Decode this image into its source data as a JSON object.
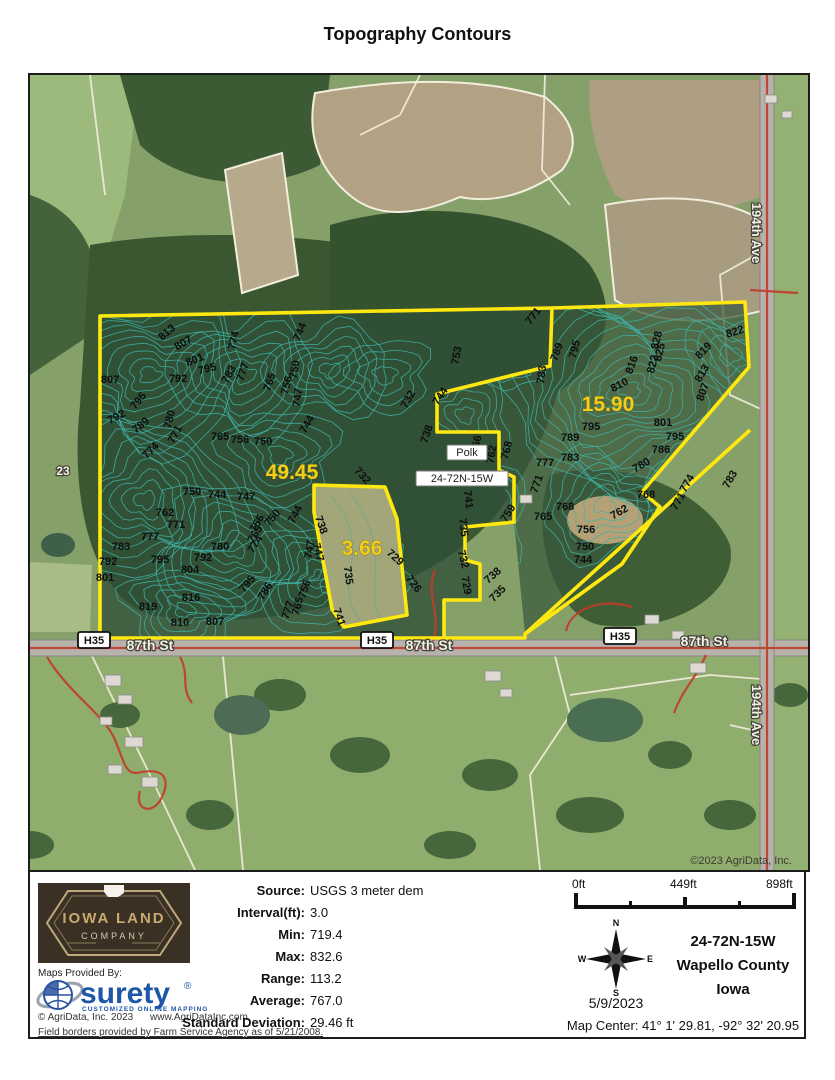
{
  "page_title": "Topography Contours",
  "map": {
    "area_labels": [
      {
        "text": "49.45",
        "x": 262,
        "y": 404
      },
      {
        "text": "15.90",
        "x": 578,
        "y": 336
      },
      {
        "text": "3.66",
        "x": 332,
        "y": 480
      }
    ],
    "place_boxes": [
      {
        "text": "Polk",
        "x": 437,
        "y": 381,
        "w": 40
      },
      {
        "text": "24-72N-15W",
        "x": 432,
        "y": 407,
        "w": 92
      }
    ],
    "section_label": {
      "text": "23",
      "x": 33,
      "y": 400
    },
    "road_labels": [
      {
        "text": "87th St",
        "x": 120,
        "y": 575,
        "rot": 0
      },
      {
        "text": "87th St",
        "x": 399,
        "y": 575,
        "rot": 0
      },
      {
        "text": "87th St",
        "x": 674,
        "y": 571,
        "rot": 0
      },
      {
        "text": "194th Ave",
        "x": 722,
        "y": 158,
        "rot": 90
      },
      {
        "text": "194th Ave",
        "x": 722,
        "y": 640,
        "rot": 90
      }
    ],
    "highway_badges": [
      {
        "text": "H35",
        "x": 64,
        "y": 569
      },
      {
        "text": "H35",
        "x": 347,
        "y": 569
      },
      {
        "text": "H35",
        "x": 590,
        "y": 565
      }
    ],
    "copyright": "©2023 AgriData, Inc.",
    "contour_labels": [
      [
        "813",
        139,
        260,
        -40
      ],
      [
        "807",
        155,
        271,
        -30
      ],
      [
        "801",
        166,
        288,
        -22
      ],
      [
        "795",
        178,
        297,
        -15
      ],
      [
        "792",
        148,
        307,
        0
      ],
      [
        "807",
        80,
        308,
        0
      ],
      [
        "774",
        207,
        266,
        -78
      ],
      [
        "783",
        202,
        301,
        -60
      ],
      [
        "777",
        216,
        298,
        -70
      ],
      [
        "765",
        243,
        308,
        -72
      ],
      [
        "756",
        260,
        311,
        -76
      ],
      [
        "750",
        268,
        295,
        -80
      ],
      [
        "747",
        271,
        323,
        -82
      ],
      [
        "744",
        273,
        258,
        -68
      ],
      [
        "744",
        280,
        351,
        -60
      ],
      [
        "795",
        111,
        328,
        -50
      ],
      [
        "792",
        88,
        345,
        -28
      ],
      [
        "789",
        113,
        353,
        -40
      ],
      [
        "780",
        143,
        345,
        -76
      ],
      [
        "771",
        148,
        361,
        -62
      ],
      [
        "774",
        123,
        378,
        -45
      ],
      [
        "765",
        190,
        365,
        0
      ],
      [
        "756",
        210,
        368,
        0
      ],
      [
        "750",
        233,
        370,
        0
      ],
      [
        "750",
        162,
        420,
        0
      ],
      [
        "744",
        187,
        423,
        0
      ],
      [
        "747",
        216,
        425,
        0
      ],
      [
        "762",
        135,
        441,
        0
      ],
      [
        "771",
        146,
        453,
        0
      ],
      [
        "777",
        120,
        465,
        0
      ],
      [
        "783",
        91,
        475,
        0
      ],
      [
        "792",
        78,
        490,
        0
      ],
      [
        "801",
        75,
        506,
        0
      ],
      [
        "795",
        130,
        488,
        0
      ],
      [
        "780",
        190,
        475,
        0
      ],
      [
        "792",
        173,
        486,
        0
      ],
      [
        "804",
        160,
        498,
        0
      ],
      [
        "819",
        118,
        535,
        0
      ],
      [
        "816",
        161,
        526,
        0
      ],
      [
        "810",
        150,
        551,
        0
      ],
      [
        "807",
        185,
        550,
        0
      ],
      [
        "795",
        220,
        511,
        -50
      ],
      [
        "786",
        238,
        518,
        -58
      ],
      [
        "756",
        230,
        450,
        -60
      ],
      [
        "765",
        228,
        461,
        -58
      ],
      [
        "774",
        228,
        471,
        -58
      ],
      [
        "750",
        245,
        445,
        -50
      ],
      [
        "744",
        268,
        441,
        -62
      ],
      [
        "747",
        283,
        475,
        -80
      ],
      [
        "756",
        278,
        515,
        -72
      ],
      [
        "765",
        271,
        532,
        -75
      ],
      [
        "777",
        261,
        536,
        -72
      ],
      [
        "741",
        306,
        543,
        72
      ],
      [
        "732",
        330,
        403,
        48
      ],
      [
        "738",
        288,
        451,
        70
      ],
      [
        "747",
        285,
        478,
        76
      ],
      [
        "735",
        315,
        501,
        82
      ],
      [
        "729",
        363,
        485,
        42
      ],
      [
        "726",
        381,
        511,
        52
      ],
      [
        "729",
        433,
        511,
        80
      ],
      [
        "732",
        430,
        485,
        76
      ],
      [
        "735",
        430,
        453,
        82
      ],
      [
        "741",
        435,
        425,
        82
      ],
      [
        "738",
        465,
        503,
        -42
      ],
      [
        "735",
        470,
        521,
        -45
      ],
      [
        "732",
        381,
        326,
        -60
      ],
      [
        "744",
        413,
        323,
        -56
      ],
      [
        "738",
        400,
        360,
        -72
      ],
      [
        "753",
        430,
        281,
        -80
      ],
      [
        "756",
        450,
        370,
        -80
      ],
      [
        "762",
        465,
        380,
        -80
      ],
      [
        "768",
        480,
        376,
        -76
      ],
      [
        "759",
        481,
        440,
        -58
      ],
      [
        "765",
        513,
        445,
        0
      ],
      [
        "768",
        535,
        435,
        0
      ],
      [
        "771",
        506,
        243,
        -52
      ],
      [
        "789",
        530,
        278,
        -70
      ],
      [
        "795",
        548,
        275,
        -76
      ],
      [
        "783",
        515,
        300,
        -82
      ],
      [
        "816",
        605,
        291,
        -70
      ],
      [
        "828",
        630,
        266,
        -76
      ],
      [
        "825",
        633,
        278,
        -76
      ],
      [
        "822",
        626,
        290,
        -76
      ],
      [
        "819",
        676,
        278,
        -46
      ],
      [
        "813",
        675,
        300,
        -60
      ],
      [
        "807",
        676,
        318,
        -70
      ],
      [
        "810",
        591,
        313,
        -28
      ],
      [
        "822",
        706,
        260,
        -18
      ],
      [
        "795",
        561,
        355,
        0
      ],
      [
        "789",
        540,
        366,
        0
      ],
      [
        "783",
        540,
        386,
        0
      ],
      [
        "777",
        515,
        391,
        0
      ],
      [
        "771",
        510,
        410,
        -70
      ],
      [
        "801",
        633,
        351,
        0
      ],
      [
        "795",
        645,
        365,
        0
      ],
      [
        "786",
        631,
        378,
        0
      ],
      [
        "780",
        613,
        393,
        -30
      ],
      [
        "768",
        616,
        423,
        0
      ],
      [
        "762",
        591,
        440,
        -30
      ],
      [
        "756",
        556,
        458,
        0
      ],
      [
        "750",
        555,
        475,
        0
      ],
      [
        "744",
        553,
        488,
        0
      ],
      [
        "774",
        660,
        410,
        -60
      ],
      [
        "771",
        651,
        428,
        -60
      ],
      [
        "783",
        703,
        406,
        -60
      ]
    ]
  },
  "footer": {
    "logo": {
      "line1": "IOWA LAND",
      "line2": "COMPANY"
    },
    "maps_provided_by": "Maps Provided By:",
    "surety": {
      "name": "surety",
      "reg": "®",
      "tagline": "CUSTOMIZED ONLINE MAPPING"
    },
    "agridata_copyright": "© AgriData, Inc. 2023",
    "agridata_url": "www.AgriDataInc.com",
    "disclaimer": "Field borders provided by Farm Service Agency as of 5/21/2008.",
    "stats": {
      "rows": [
        {
          "label": "Source:",
          "value": "USGS 3 meter dem"
        },
        {
          "label": "Interval(ft):",
          "value": "3.0"
        },
        {
          "label": "Min:",
          "value": "719.4"
        },
        {
          "label": "Max:",
          "value": "832.6"
        },
        {
          "label": "Range:",
          "value": "113.2"
        },
        {
          "label": "Average:",
          "value": "767.0"
        },
        {
          "label": "Standard Deviation:",
          "value": "29.46 ft"
        }
      ]
    },
    "scale": {
      "start": "0ft",
      "mid": "449ft",
      "end": "898ft"
    },
    "compass": {
      "n": "N",
      "e": "E",
      "s": "S",
      "w": "W",
      "date": "5/9/2023"
    },
    "location": {
      "trs": "24-72N-15W",
      "county": "Wapello County",
      "state": "Iowa"
    },
    "map_center": "Map Center: 41° 1' 29.81,  -92° 32' 20.95"
  },
  "colors": {
    "boundary_yellow": "#ffe810",
    "contour_teal": "#3fb3a9",
    "road_red": "#c23b2a",
    "surety_blue": "#1e57a8",
    "area_label_yellow": "#f3cf1b"
  }
}
